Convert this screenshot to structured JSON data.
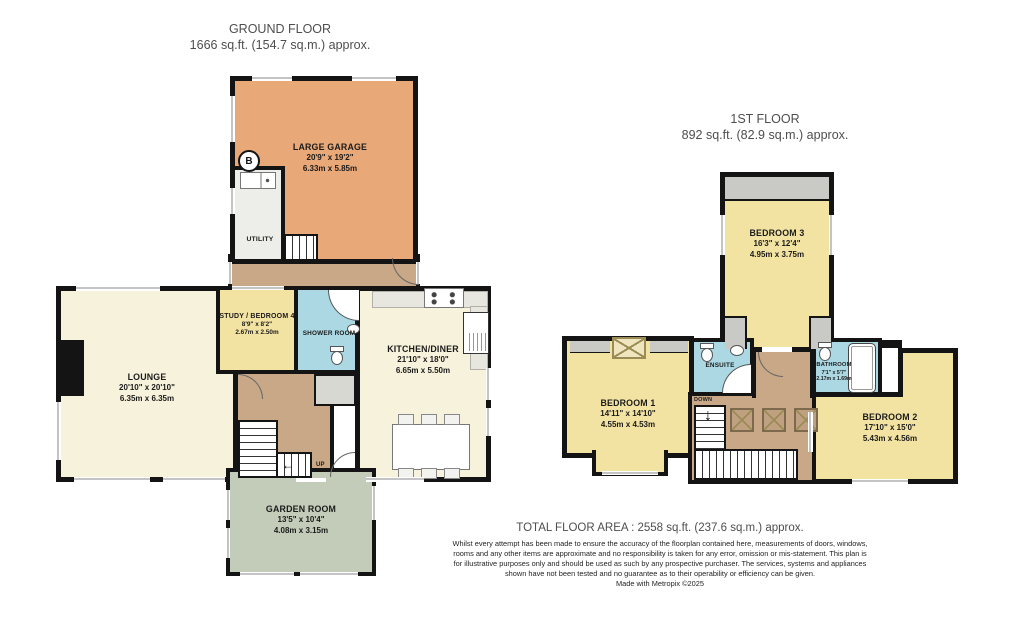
{
  "ground_floor": {
    "title": "GROUND FLOOR",
    "area": "1666 sq.ft. (154.7 sq.m.) approx.",
    "rooms": [
      {
        "name": "LARGE GARAGE",
        "dims_imperial": "20'9\" x 19'2\"",
        "dims_metric": "6.33m x 5.85m"
      },
      {
        "name": "UTILITY",
        "dims_imperial": "",
        "dims_metric": ""
      },
      {
        "name": "LOUNGE",
        "dims_imperial": "20'10\" x 20'10\"",
        "dims_metric": "6.35m x 6.35m"
      },
      {
        "name": "STUDY / BEDROOM 4",
        "dims_imperial": "8'9\" x 8'2\"",
        "dims_metric": "2.67m x 2.50m"
      },
      {
        "name": "SHOWER ROOM",
        "dims_imperial": "",
        "dims_metric": ""
      },
      {
        "name": "KITCHEN/DINER",
        "dims_imperial": "21'10\" x 18'0\"",
        "dims_metric": "6.65m x 5.50m"
      },
      {
        "name": "GARDEN ROOM",
        "dims_imperial": "13'5\" x 10'4\"",
        "dims_metric": "4.08m x 3.15m"
      }
    ],
    "labels": {
      "up": "UP",
      "boiler": "B"
    }
  },
  "first_floor": {
    "title": "1ST FLOOR",
    "area": "892 sq.ft. (82.9 sq.m.) approx.",
    "rooms": [
      {
        "name": "BEDROOM 3",
        "dims_imperial": "16'3\" x 12'4\"",
        "dims_metric": "4.95m x 3.75m"
      },
      {
        "name": "BEDROOM 1",
        "dims_imperial": "14'11\" x 14'10\"",
        "dims_metric": "4.55m x 4.53m"
      },
      {
        "name": "ENSUITE",
        "dims_imperial": "",
        "dims_metric": ""
      },
      {
        "name": "BATHROOM",
        "dims_imperial": "7'1\" x 5'7\"",
        "dims_metric": "2.17m x 1.69m"
      },
      {
        "name": "BEDROOM 2",
        "dims_imperial": "17'10\" x 15'0\"",
        "dims_metric": "5.43m x 4.56m"
      }
    ],
    "labels": {
      "down": "DOWN"
    }
  },
  "footer": {
    "total": "TOTAL FLOOR AREA : 2558 sq.ft. (237.6 sq.m.) approx.",
    "disclaimer": "Whilst every attempt has been made to ensure the accuracy of the floorplan contained here, measurements of doors, windows, rooms and any other items are approximate and no responsibility is taken for any error, omission or mis-statement. This plan is for illustrative purposes only and should be used as such by any prospective purchaser. The services, systems and appliances shown have not been tested and no guarantee as to their operability or efficiency can be given.",
    "credit": "Made with Metropix ©2025"
  },
  "icons": {
    "up_arrow": "←",
    "down_arrow": "↓"
  },
  "colors": {
    "wall": "#141414",
    "garage_orange": "#E9A877",
    "cream": "#F7F2DB",
    "yellow": "#F3E3A2",
    "bath_blue": "#ABD8E3",
    "hall_tan": "#C8A887",
    "garden_sage": "#C2CCB8",
    "eaves_gray": "#C9C9C5",
    "fixture_gray": "#E7E7E0"
  }
}
